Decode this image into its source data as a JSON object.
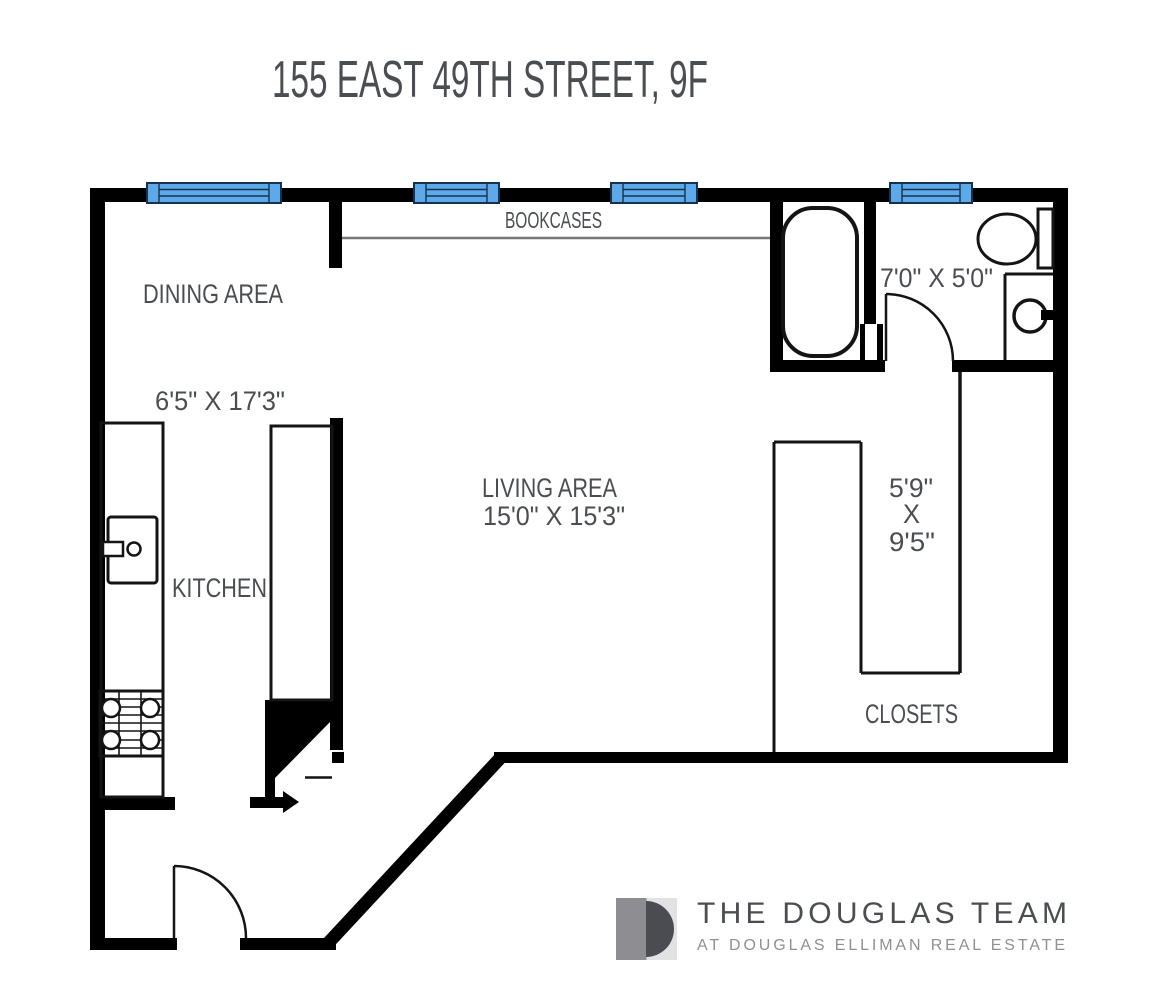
{
  "title": "155 EAST 49TH STREET, 9F",
  "floorplan": {
    "labels": {
      "dining_area": "DINING AREA",
      "dining_dim": "6'5\" X 17'3\"",
      "kitchen": "KITCHEN",
      "living_area": "LIVING AREA",
      "living_dim": "15'0\" X 15'3\"",
      "bathroom_dim": "7'0\" X 5'0\"",
      "bookcases": "BOOKCASES",
      "closets": "CLOSETS",
      "closet_dim_w": "5'9\"",
      "closet_dim_x": "X",
      "closet_dim_l": "9'5\""
    },
    "colors": {
      "wall": "#000000",
      "window_fill": "#5EA9E9",
      "window_border": "#16324E",
      "text": "#4A4D51",
      "bookcase_line": "#777777"
    },
    "window_count": 4
  },
  "branding": {
    "team_name": "THE DOUGLAS TEAM",
    "tagline": "AT DOUGLAS ELLIMAN REAL ESTATE",
    "logo_colors": {
      "square_left": "#8E8E92",
      "square_right": "#E2E2E4",
      "monogram": "#4A4C51"
    }
  }
}
